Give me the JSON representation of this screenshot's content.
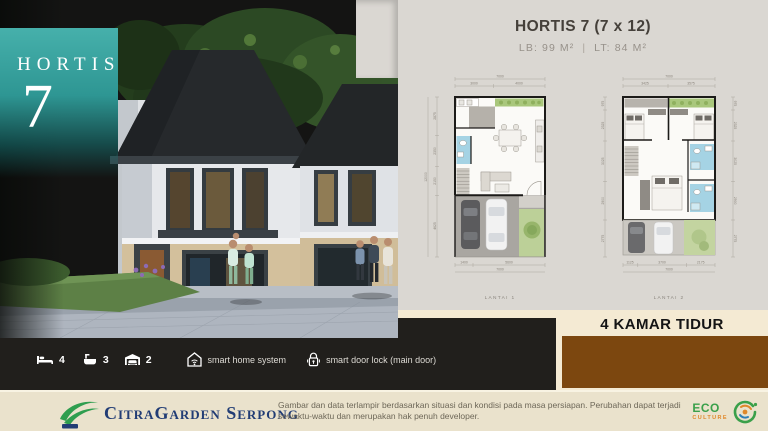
{
  "badge": {
    "line1": "HORTIS",
    "line2": "7"
  },
  "panel": {
    "title": "HORTIS 7 (7 x 12)",
    "lb": "LB: 99 M²",
    "divider": "|",
    "lt": "LT: 84 M²"
  },
  "plans": [
    {
      "label": "LANTAI 1",
      "dim_total_top": "7000",
      "dims_top": [
        "3000",
        "4000"
      ],
      "dim_total_left": "12000",
      "dims_left": [
        "2875",
        "2350",
        "2150",
        "4625"
      ],
      "dims_bottom": [
        "1400",
        "5600"
      ],
      "dim_total_bottom": "7000"
    },
    {
      "label": "LANTAI 2",
      "dim_total_top": "7000",
      "dims_top": [
        "3425",
        "3575"
      ],
      "dims_left": [
        "975",
        "2325",
        "3025",
        "2900",
        "2775"
      ],
      "dims_right": [
        "975",
        "2325",
        "3025",
        "2900",
        "2775"
      ],
      "dims_bottom": [
        "1125",
        "3700",
        "2175"
      ],
      "dim_total_bottom": "7000"
    }
  ],
  "banner": {
    "text": "4 KAMAR TIDUR"
  },
  "features": {
    "bed_count": "4",
    "bath_count": "3",
    "garage_count": "2",
    "smart_home": "smart home system",
    "smart_lock": "smart door lock (main door)"
  },
  "footer": {
    "brand": "CitraGarden Serpong",
    "disclaimer": "Gambar dan data terlampir berdasarkan situasi dan kondisi pada masa persiapan. Perubahan dapat terjadi sewaktu-waktu dan merupakan hak penuh developer.",
    "eco_line1": "ECO",
    "eco_line2": "CULTURE"
  },
  "colors": {
    "teal": "#2e9693",
    "brown": "#7c470f",
    "cream": "#f4ead3",
    "dark_strip": "#211f1c",
    "panel_bg": "#dad7d2",
    "navy": "#223d75",
    "eco_green": "#3aa04a",
    "eco_orange": "#e0882a"
  }
}
